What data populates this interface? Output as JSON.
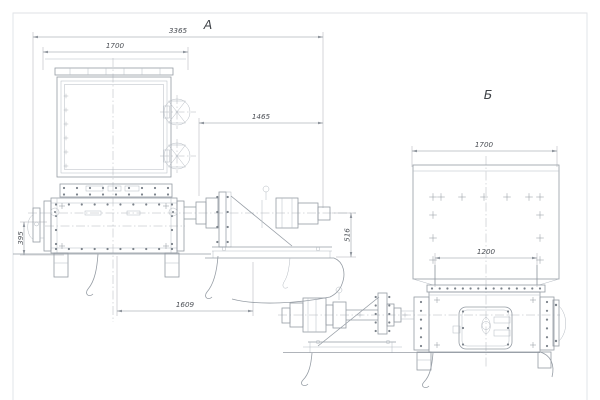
{
  "views": {
    "a": {
      "label": "А",
      "dims": {
        "overall": "3365",
        "hopper_width": "1700",
        "drive_length": "1465",
        "side_height": "395",
        "drive_height": "516",
        "base_length": "1609"
      }
    },
    "b": {
      "label": "Б",
      "dims": {
        "hopper_width": "1700",
        "outlet_width": "1200"
      }
    }
  },
  "colors": {
    "line": "#959ca4",
    "thin": "#b4bac1",
    "center": "#b0b6bd",
    "dim": "#8e949c",
    "text": "#4c5056",
    "label": "#3f4348",
    "border": "#dfe2e6",
    "bg": "#ffffff"
  }
}
